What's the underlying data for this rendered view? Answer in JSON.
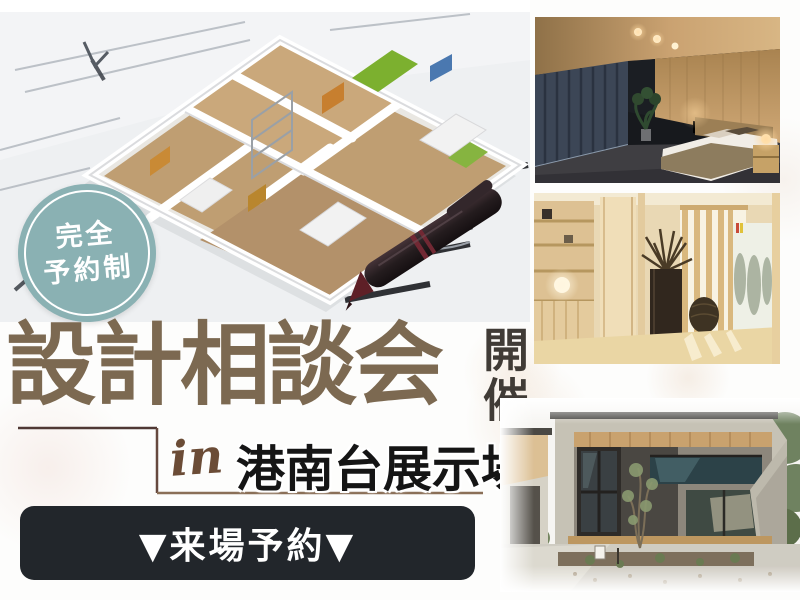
{
  "banner": {
    "badge": {
      "line1": "完全",
      "line2": "予約制"
    },
    "title": {
      "main": "設計相談会",
      "suffix": "開催"
    },
    "location": {
      "script_prefix": "in",
      "venue": "港南台展示場"
    },
    "cta": {
      "label": "▼来場予約▼"
    }
  },
  "colors": {
    "badge_bg": "#8ab1b3",
    "title_brown": "#7c6951",
    "suffix_dark": "#403b36",
    "script_brown": "#6b4c36",
    "venue_black": "#151515",
    "cta_bg": "#22262b",
    "cta_text": "#ffffff",
    "frame_dark": "#4f3834",
    "frame_brown": "#8a6f57"
  },
  "illustrations": {
    "hero": "3d-floorplan-model-on-blueprints-with-pen",
    "photo1": "bedroom-interior",
    "photo2": "entryway-interior",
    "photo3": "modern-house-exterior"
  }
}
